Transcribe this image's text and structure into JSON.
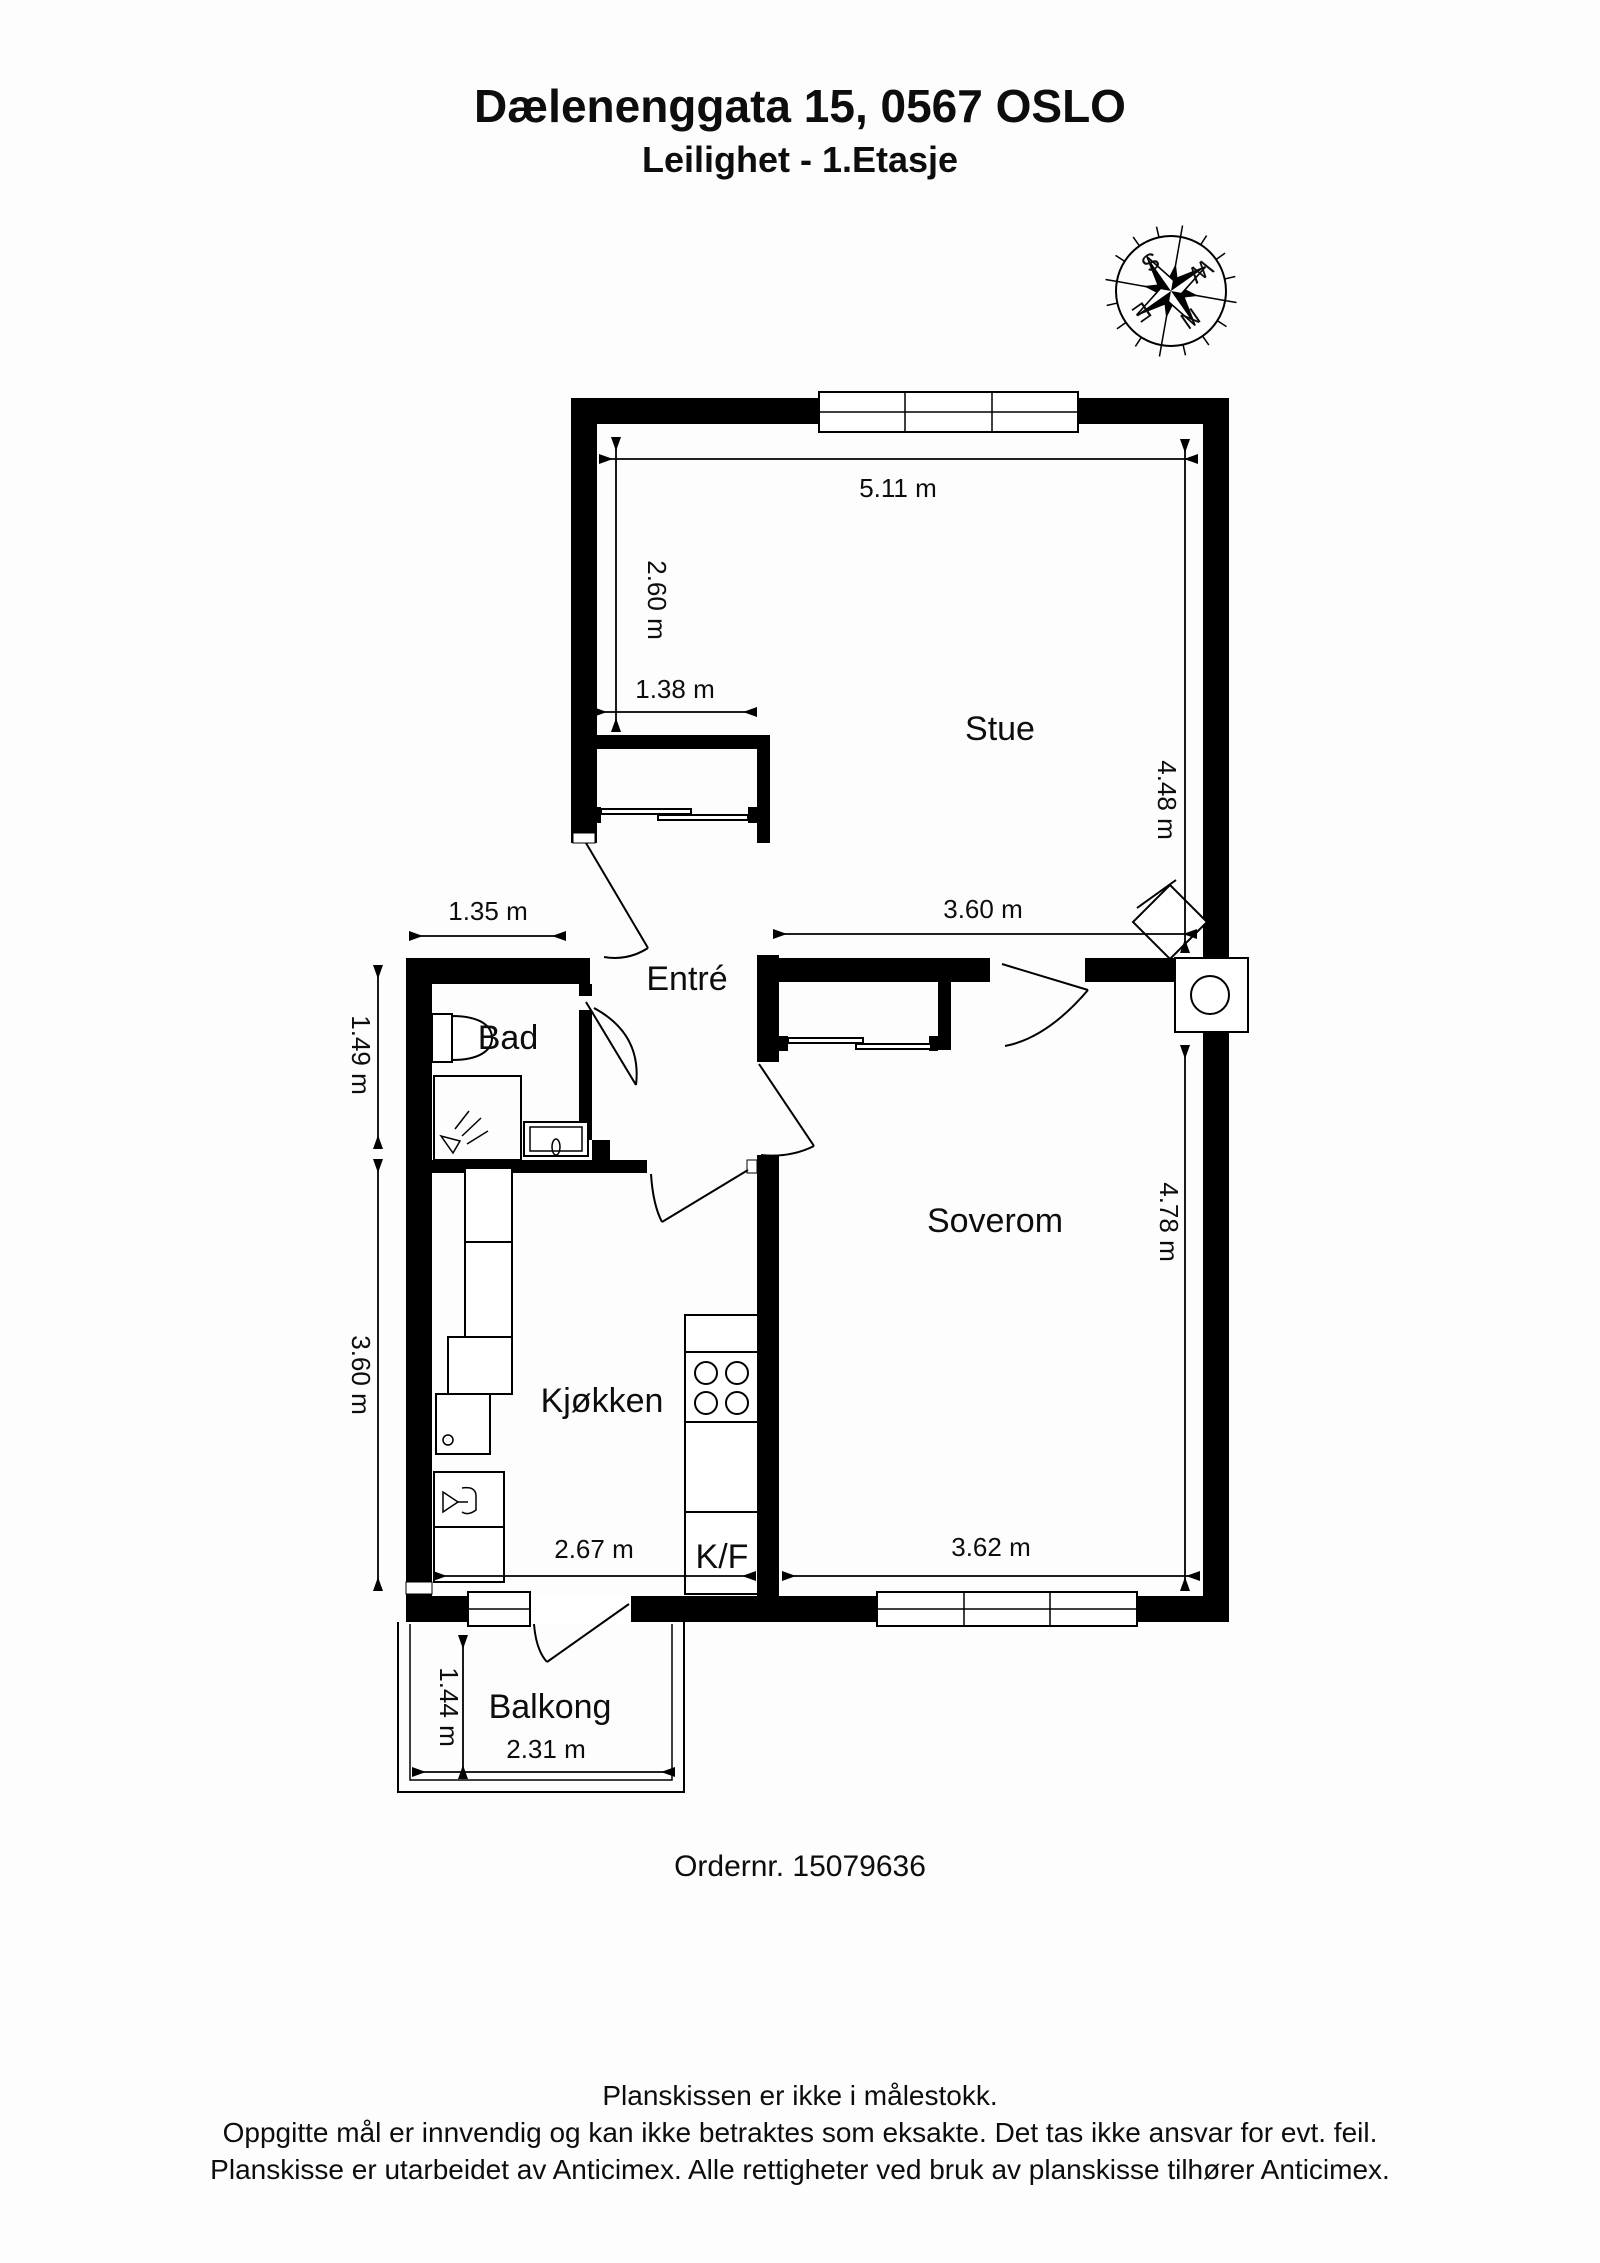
{
  "title": {
    "line1": "Dælenenggata 15, 0567 OSLO",
    "line2": "Leilighet  - 1.Etasje"
  },
  "compass": {
    "n": "N",
    "e": "E",
    "s": "S",
    "w": "W"
  },
  "rooms": {
    "stue": "Stue",
    "entre": "Entré",
    "bad": "Bad",
    "kjokken": "Kjøkken",
    "soverom": "Soverom",
    "balkong": "Balkong",
    "kf": "K/F"
  },
  "dimensions": {
    "stue_width": "5.11 m",
    "stue_left_height": "2.60 m",
    "alcove_width": "1.38 m",
    "stue_height_right": "4.48 m",
    "stue_lower_width": "3.60 m",
    "bad_width": "1.35 m",
    "bad_height": "1.49 m",
    "kjokken_height": "3.60 m",
    "kjokken_width": "2.67 m",
    "soverom_width": "3.62 m",
    "soverom_height": "4.78 m",
    "balkong_height": "1.44 m",
    "balkong_width": "2.31 m"
  },
  "order": {
    "label": "Ordernr. 15079636"
  },
  "footer": {
    "line1": "Planskissen er ikke i målestokk.",
    "line2": "Oppgitte mål er innvendig og kan ikke betraktes som eksakte. Det tas ikke ansvar for evt. feil.",
    "line3": "Planskisse er utarbeidet av Anticimex. Alle rettigheter ved bruk av planskisse tilhører Anticimex."
  },
  "colors": {
    "line": "#000000",
    "background": "#fdfdfd"
  }
}
